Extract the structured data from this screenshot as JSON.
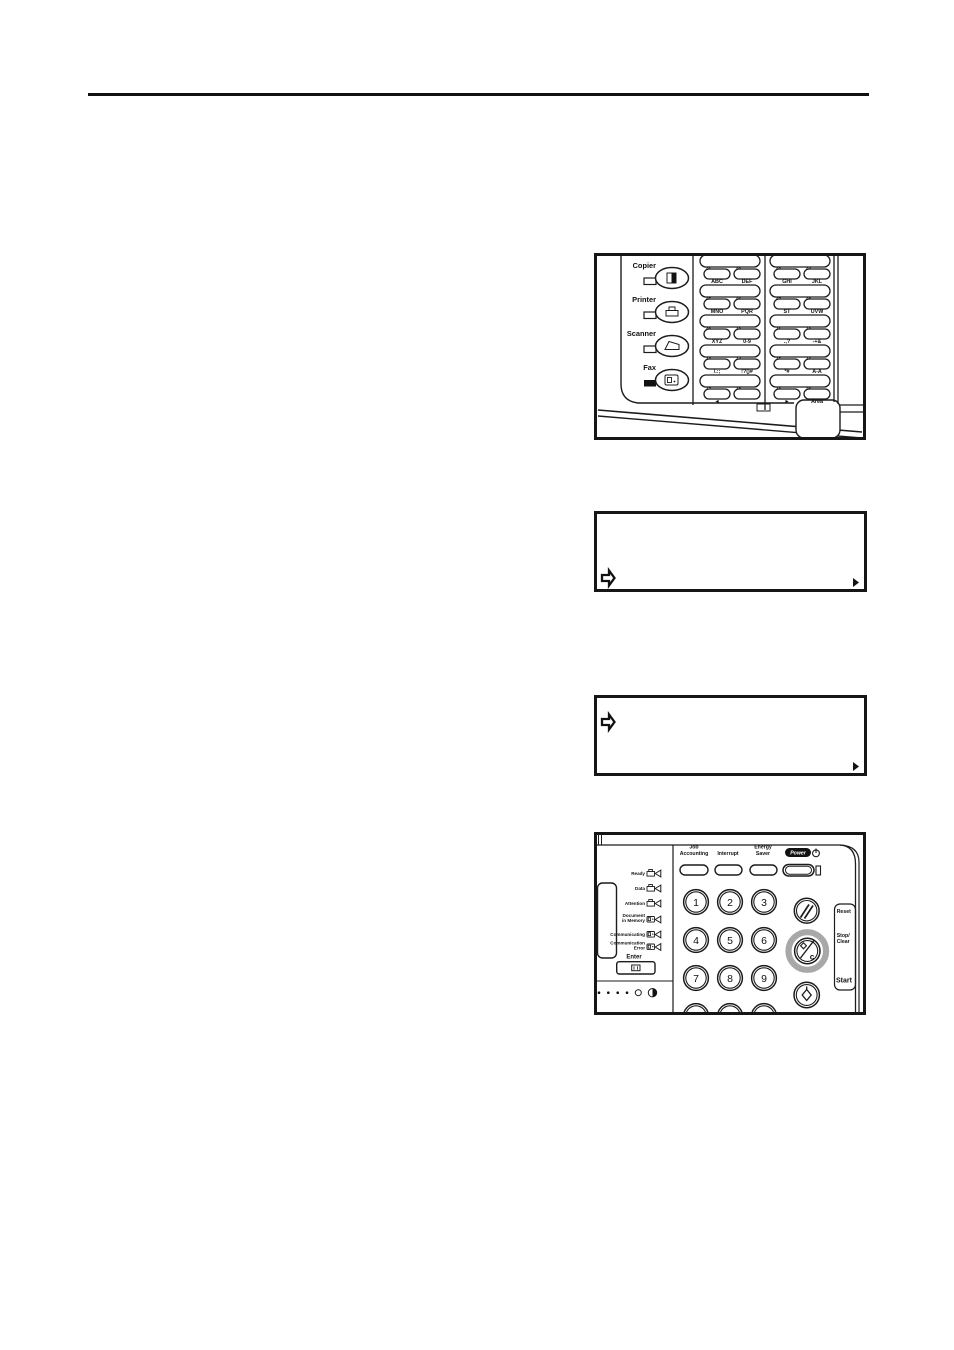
{
  "page": {
    "background": "#ffffff",
    "rule_color": "#111111"
  },
  "figures": {
    "mode_panel": {
      "mode_keys": [
        {
          "label": "Copier",
          "led": "off",
          "icon": "copier-icon"
        },
        {
          "label": "Printer",
          "led": "off",
          "icon": "printer-icon"
        },
        {
          "label": "Scanner",
          "led": "off",
          "icon": "scanner-icon"
        },
        {
          "label": "Fax",
          "led": "on",
          "icon": "fax-icon"
        }
      ],
      "one_touch_keys": [
        {
          "num": "01",
          "label": "ABC"
        },
        {
          "num": "02",
          "label": "DEF"
        },
        {
          "num": "03",
          "label": "GHI"
        },
        {
          "num": "04",
          "label": "JKL"
        },
        {
          "num": "05",
          "label": "MNO"
        },
        {
          "num": "06",
          "label": "PQR"
        },
        {
          "num": "07",
          "label": "ST"
        },
        {
          "num": "08",
          "label": "UVW"
        },
        {
          "num": "09",
          "label": "XYZ"
        },
        {
          "num": "10",
          "label": "0-9"
        },
        {
          "num": "11",
          "label": ".,?"
        },
        {
          "num": "12",
          "label": "-+&"
        },
        {
          "num": "13",
          "label": "/.:;"
        },
        {
          "num": "14",
          "label": "!?()#"
        },
        {
          "num": "15",
          "label": "*#"
        },
        {
          "num": "16",
          "label": "A-A"
        },
        {
          "num": "17",
          "label": "◄"
        },
        {
          "num": "18",
          "label": ""
        },
        {
          "num": "19",
          "label": "►"
        },
        {
          "num": "20",
          "label": "Area"
        }
      ]
    },
    "display_1": {
      "icons": {
        "left_bottom": "step-arrow-icon",
        "bottom_right": "more-indicator-triangle"
      }
    },
    "display_2": {
      "icons": {
        "left_top": "step-arrow-icon",
        "bottom_right": "more-indicator-triangle"
      }
    },
    "operation_panel": {
      "top_buttons": [
        {
          "line1": "Job",
          "line2": "Accounting"
        },
        {
          "line1": "Interrupt",
          "line2": ""
        },
        {
          "line1": "Energy",
          "line2": "Saver"
        }
      ],
      "power_badge": "Power",
      "status_indicators": [
        {
          "line1": "Ready",
          "line2": "",
          "icon": "printer-icon"
        },
        {
          "line1": "Data",
          "line2": "",
          "icon": "printer-icon"
        },
        {
          "line1": "Attention",
          "line2": "",
          "icon": "printer-icon"
        },
        {
          "line1": "Document",
          "line2": "in Memory",
          "icon": "fax-icon"
        },
        {
          "line1": "Communicating",
          "line2": "",
          "icon": "fax-icon"
        },
        {
          "line1": "Communication",
          "line2": "Error",
          "icon": "fax-icon"
        }
      ],
      "enter": {
        "label": "Enter"
      },
      "keypad_digits": [
        "1",
        "2",
        "3",
        "4",
        "5",
        "6",
        "7",
        "8",
        "9"
      ],
      "right_column": {
        "reset_label": "Reset",
        "stop_clear_line1": "Stop/",
        "stop_clear_line2": "Clear",
        "stop_clear_key_letter": "c",
        "start_label": "Start"
      },
      "highlight": {
        "stop_clear_ring_color": "#a8a8a8"
      }
    }
  }
}
